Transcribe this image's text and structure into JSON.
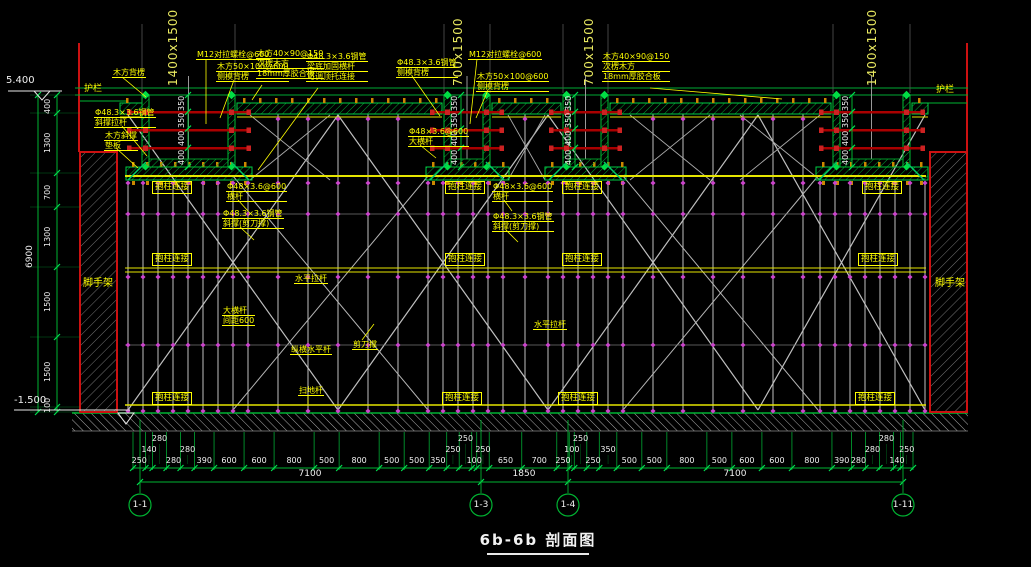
{
  "title": "6b-6b 剖面图",
  "elevations": {
    "top": "5.400",
    "bottom": "-1.500"
  },
  "guardrail_label": "护栏",
  "scaffold_wall_label": "脚手架",
  "colors": {
    "line_green": "#00b332",
    "arrow_green": "#00e050",
    "dim_white": "#f0f0f0",
    "annotation_yellow": "#ffff00",
    "wall_red": "#cc1111",
    "tie_red": "#aa0000",
    "fastener_magenta": "#cc44cc",
    "post_gray": "#b0b0b0",
    "ledger_yellow": "#e6e600",
    "joist_amber": "#cc8800",
    "brace_green": "#00cc66"
  },
  "beams": [
    {
      "size_label": "1400x1500",
      "x1": 142,
      "x2": 235,
      "bar_x1": 128,
      "bar_x2": 250,
      "dim_x": 188,
      "label_x": 167
    },
    {
      "size_label": "700x1500",
      "x1": 444,
      "x2": 490,
      "bar_x1": 431,
      "bar_x2": 503,
      "dim_x": 461,
      "label_x": 452
    },
    {
      "size_label": "700x1500",
      "x1": 563,
      "x2": 608,
      "bar_x1": 550,
      "bar_x2": 621,
      "dim_x": 575,
      "label_x": 583
    },
    {
      "size_label": "1400x1500",
      "x1": 833,
      "x2": 910,
      "bar_x1": 820,
      "bar_x2": 924,
      "dim_x": 852,
      "label_x": 866
    }
  ],
  "beam_dim_values": [
    "350",
    "350",
    "400",
    "400"
  ],
  "left_dims": {
    "segments": [
      "400",
      "1300",
      "700",
      "1300",
      "1500",
      "1500",
      "100"
    ],
    "total": "6900"
  },
  "column_tie_label": "抱柱连接",
  "column_tie_positions": [
    [
      152,
      181
    ],
    [
      445,
      181
    ],
    [
      562,
      181
    ],
    [
      862,
      181
    ],
    [
      152,
      253
    ],
    [
      445,
      253
    ],
    [
      562,
      253
    ],
    [
      858,
      253
    ],
    [
      152,
      392
    ],
    [
      442,
      392
    ],
    [
      558,
      392
    ],
    [
      855,
      392
    ]
  ],
  "annotations": [
    {
      "x": 112,
      "y": 68,
      "lines": [
        "木方背楞"
      ],
      "leader": [
        122,
        77,
        146,
        97
      ]
    },
    {
      "x": 94,
      "y": 108,
      "lines": [
        "Φ48.3×3.6钢管",
        "斜撑拉杆"
      ],
      "leader": [
        122,
        126,
        147,
        156
      ]
    },
    {
      "x": 104,
      "y": 131,
      "lines": [
        "木方斜撑",
        "垫板"
      ],
      "leader": [
        116,
        148,
        138,
        168
      ]
    },
    {
      "x": 196,
      "y": 50,
      "lines": [
        "M12对拉螺栓@600"
      ],
      "leader": [
        206,
        59,
        206,
        124
      ]
    },
    {
      "x": 216,
      "y": 62,
      "lines": [
        "木方50×100@600",
        "侧模背楞"
      ],
      "leader": [
        234,
        80,
        220,
        118
      ]
    },
    {
      "x": 256,
      "y": 49,
      "lines": [
        "木方40×90@150",
        "次楞木方",
        "18mm厚胶合板"
      ],
      "leader": [
        262,
        85,
        252,
        100
      ]
    },
    {
      "x": 306,
      "y": 52,
      "lines": [
        "Φ48.3×3.6钢管",
        "梁底加固横杆",
        "可调顶托连接"
      ],
      "leader": [
        318,
        88,
        258,
        170
      ]
    },
    {
      "x": 396,
      "y": 58,
      "lines": [
        "Φ48.3×3.6钢管",
        "侧模背楞"
      ],
      "leader": [
        412,
        76,
        440,
        116
      ]
    },
    {
      "x": 468,
      "y": 50,
      "lines": [
        "M12对拉螺栓@600"
      ],
      "leader": [
        477,
        59,
        470,
        124
      ]
    },
    {
      "x": 476,
      "y": 72,
      "lines": [
        "木方50×100@600",
        "侧模背楞"
      ],
      "leader": [
        488,
        90,
        476,
        118
      ]
    },
    {
      "x": 408,
      "y": 127,
      "lines": [
        "Φ48×3.6@600",
        "大横杆"
      ],
      "leader": [
        420,
        145,
        436,
        158
      ]
    },
    {
      "x": 602,
      "y": 52,
      "lines": [
        "木方40×90@150",
        "次楞木方",
        "18mm厚胶合板"
      ],
      "leader": [
        650,
        88,
        782,
        99
      ]
    },
    {
      "x": 226,
      "y": 182,
      "lines": [
        "Φ48×3.6@600",
        "横杆"
      ],
      "leader": [
        238,
        200,
        248,
        211
      ]
    },
    {
      "x": 222,
      "y": 209,
      "lines": [
        "Φ48.3×3.6钢管",
        "斜撑(剪刀撑)"
      ],
      "leader": [
        240,
        227,
        254,
        240
      ]
    },
    {
      "x": 492,
      "y": 182,
      "lines": [
        "Φ48×3.6@600",
        "横杆"
      ],
      "leader": [
        504,
        200,
        512,
        211
      ]
    },
    {
      "x": 492,
      "y": 212,
      "lines": [
        "Φ48.3×3.6钢管",
        "斜撑(剪刀撑)"
      ],
      "leader": [
        506,
        230,
        518,
        242
      ]
    },
    {
      "x": 294,
      "y": 274,
      "lines": [
        "水平拉杆"
      ]
    },
    {
      "x": 533,
      "y": 320,
      "lines": [
        "水平拉杆"
      ]
    },
    {
      "x": 222,
      "y": 306,
      "lines": [
        "大横杆",
        "间距600"
      ]
    },
    {
      "x": 290,
      "y": 345,
      "lines": [
        "纵横水平杆"
      ]
    },
    {
      "x": 352,
      "y": 340,
      "lines": [
        "剪刀撑"
      ],
      "leader": [
        362,
        340,
        374,
        324
      ]
    },
    {
      "x": 298,
      "y": 386,
      "lines": [
        "扫地杆"
      ],
      "leader": [
        308,
        395,
        308,
        404
      ]
    }
  ],
  "bottom_dims": {
    "values": [
      250,
      140,
      280,
      280,
      280,
      390,
      600,
      600,
      800,
      500,
      800,
      500,
      500,
      350,
      250,
      250,
      100,
      250,
      650,
      700,
      250,
      100,
      250,
      250,
      350,
      500,
      500,
      800,
      500,
      600,
      600,
      800,
      390,
      280,
      280,
      280,
      140,
      250
    ],
    "totals": [
      "7100",
      "1850",
      "7100"
    ],
    "axis_labels": [
      "1-1",
      "1-3",
      "1-4",
      "1-11"
    ]
  }
}
